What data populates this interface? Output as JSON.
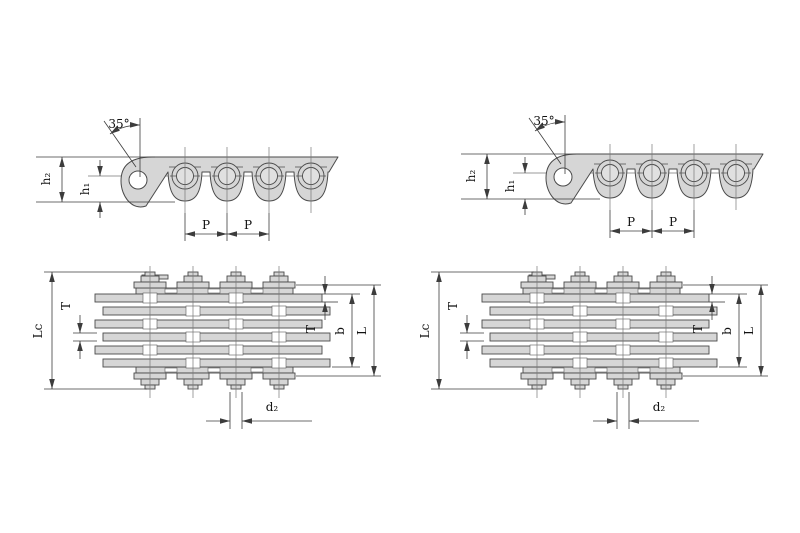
{
  "colors": {
    "background": "#ffffff",
    "plate_fill": "#d6d6d6",
    "outline": "#4a4a4a",
    "dimension_line": "#3c3c3c"
  },
  "drawings": {
    "side_view_left": {
      "labels": {
        "angle": "35°",
        "h2": "h₂",
        "h1": "h₁",
        "p_left": "P",
        "p_right": "P"
      }
    },
    "side_view_right": {
      "labels": {
        "angle": "35°",
        "h2": "h₂",
        "h1": "h₁",
        "p_left": "P",
        "p_right": "P"
      }
    },
    "plan_view_left": {
      "labels": {
        "lc": "Lc",
        "t_left": "T",
        "t_right": "T",
        "b": "b",
        "l": "L",
        "d2": "d₂"
      }
    },
    "plan_view_right": {
      "labels": {
        "lc": "Lc",
        "t_left": "T",
        "t_right": "T",
        "b": "b",
        "l": "L",
        "d2": "d₂"
      }
    }
  }
}
